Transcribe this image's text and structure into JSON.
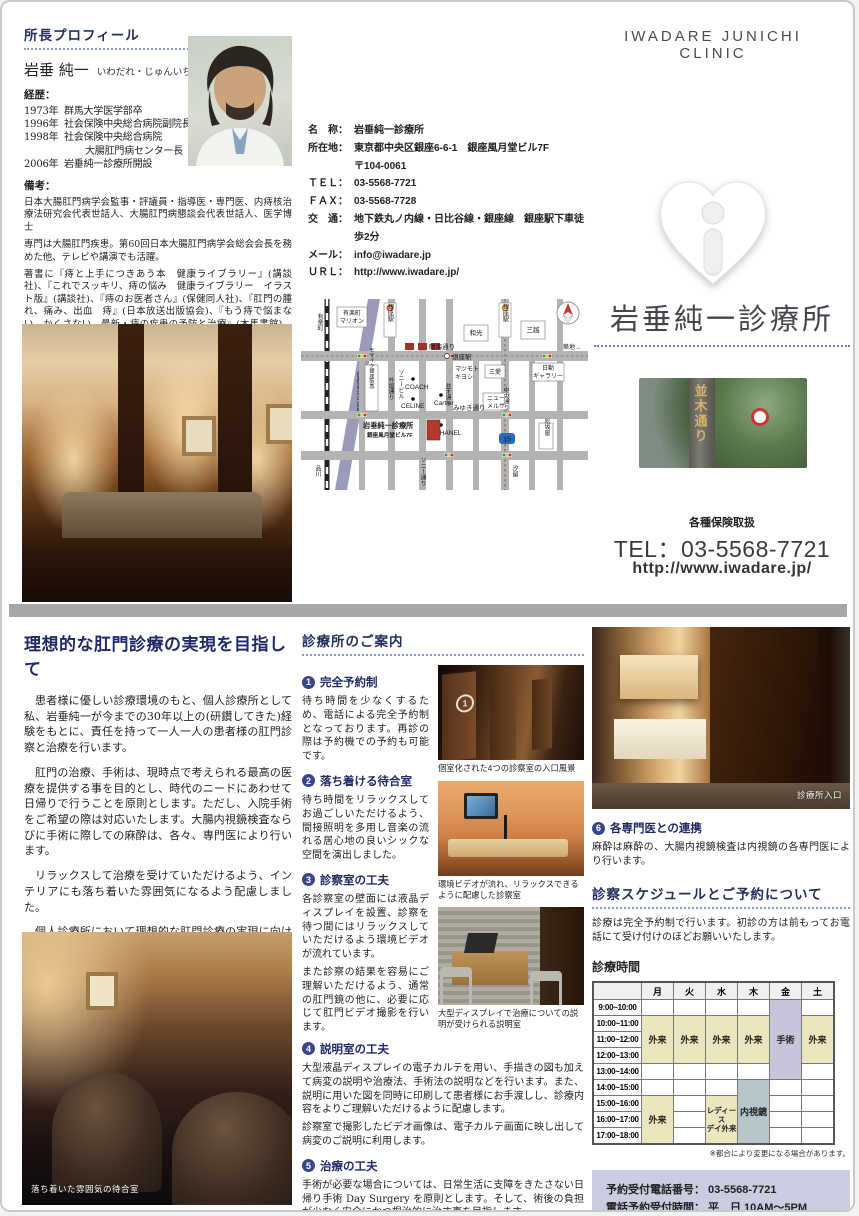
{
  "brand": {
    "header": "IWADARE JUNICHI CLINIC",
    "name": "岩垂純一診療所",
    "insurance_note": "各種保険取扱",
    "tel": "TEL：03-5568-7721",
    "url": "http://www.iwadare.jp/",
    "sign_text": "並木通り"
  },
  "profile": {
    "heading": "所長プロフィール",
    "name": "岩垂 純一",
    "kana": "いわだれ・じゅんいち",
    "career_label": "経歴：",
    "career": [
      [
        "1973年",
        "群馬大学医学部卒"
      ],
      [
        "1996年",
        "社会保険中央総合病院副院長"
      ],
      [
        "1998年",
        "社会保険中央総合病院"
      ],
      [
        "",
        "大腸肛門病センター長"
      ],
      [
        "2006年",
        "岩垂純一診療所開設"
      ]
    ],
    "notes_label": "備考：",
    "notes": [
      "日本大腸肛門病学会監事・評議員・指導医・専門医、内痔核治療法研究会代表世話人、大腸肛門病懇談会代表世話人、医学博士",
      "専門は大腸肛門疾患。第60回日本大腸肛門病学会総会会長を務めた他、テレビや講演でも活躍。",
      "著書に『痔と上手につきあう本　健康ライブラリー』(講談社)、『これでスッキリ、痔の悩み　健康ライブラリー　イラスト版』(講談社)、『痔のお医者さん』(保健同人社)、『肛門の腫れ、痛み、出血　痔』(日本放送出版協会)、『もう痔で悩まない、かくさない　最新・痔の疾患の予防と治療』(木馬書館)、『実地医家のための肛門疾患診療プラクティス』(永井書店)、『肛門疾患Day　Surgeryの実際―私はこのように行っている』(真興交易(株)医書出版部)など。"
    ]
  },
  "contact": {
    "rows": [
      [
        "名　称：",
        "岩垂純一診療所"
      ],
      [
        "所在地：",
        "東京都中央区銀座6-6-1　銀座風月堂ビル7F"
      ],
      [
        "",
        "〒104-0061"
      ],
      [
        "ＴＥＬ：",
        "03-5568-7721"
      ],
      [
        "ＦＡＸ：",
        "03-5568-7728"
      ],
      [
        "交　通：",
        "地下鉄丸ノ内線・日比谷線・銀座線　銀座駅下車徒歩2分"
      ],
      [
        "メール：",
        "info@iwadare.jp"
      ],
      [
        "ＵＲＬ：",
        "http://www.iwadare.jp/"
      ]
    ]
  },
  "map": {
    "labels": {
      "yurakucho": "有楽町",
      "marion1": "有楽町",
      "marion2": "マリオン",
      "ginza_sta": "銀座駅",
      "harumi": "晴海通り",
      "tsukiji": "築地→",
      "wako": "和光",
      "mitsukoshi": "三越",
      "nichido1": "日動",
      "nichido2": "ギャラリー",
      "mosaic": "モザイク銀座阪急",
      "sotobori": "外堀通り",
      "sony_bldg": "ソニービル",
      "coach": "COACH",
      "matsukiyo1": "マツモト",
      "matsukiyo2": "キヨシ",
      "namiki": "並木通り",
      "celine": "CELINE",
      "cartier": "Cartier",
      "sanai": "三愛",
      "melsa1": "ニュー",
      "melsa2": "メルサ",
      "chuo": "中央通り",
      "miyuki": "みゆき通り",
      "chanel": "CHANEL",
      "route15": "15",
      "matsuzakaya": "松坂屋",
      "sony_st": "ソニー通り",
      "expressway": "首都高速の連絡線",
      "shinagawa": "品川",
      "shiodome": "汐留"
    },
    "clinic": {
      "line1": "岩垂純一診療所",
      "line2": "銀座風月堂ビル7F"
    }
  },
  "article": {
    "title": "理想的な肛門診療の実現を目指して",
    "paragraphs": [
      "患者様に優しい診療環境のもと、個人診療所として私、岩垂純一が今までの30年以上の(研鑽してきた)経験をもとに、責任を持って一人一人の患者様の肛門診察と治療を行います。",
      "肛門の治療、手術は、現時点で考えられる最高の医療を提供する事を目的とし、時代のニードにあわせて日帰りで行うことを原則とします。ただし、入院手術をご希望の際は対応いたします。大腸内視鏡検査ならびに手術に際しての麻酔は、各々、専門医により行います。",
      "リラックスして治療を受けていただけるよう、インテリアにも落ち着いた雰囲気になるよう配慮しました。",
      "個人診療所において理想的な肛門診療の実現に向けて日々、努力してまいりたいと思いますので、よろしくお願い申し上げます。"
    ],
    "signature_role": "所長",
    "signature_name": "岩垂 純一"
  },
  "guide": {
    "heading": "診療所のご案内",
    "sections": [
      {
        "num": "1",
        "title": "完全予約制",
        "body": "待ち時間を少なくするため、電話による完全予約制となっております。再診の際は予約機での予約も可能です。"
      },
      {
        "num": "2",
        "title": "落ち着ける待合室",
        "body": "待ち時間をリラックスしてお過ごしいただけるよう、間接照明を多用し音楽の流れる居心地の良いシックな空間を演出しました。"
      },
      {
        "num": "3",
        "title": "診察室の工夫",
        "body": "各診察室の壁面には液晶ディスプレイを設置、診察を待つ間にはリラックスしていただけるよう環境ビデオが流れています。",
        "body2": "また診察の結果を容易にご理解いただけるよう、通常の肛門鏡の他に、必要に応じて肛門ビデオ撮影を行います。"
      },
      {
        "num": "4",
        "title": "説明室の工夫",
        "body": "大型液晶ディスプレイの電子カルテを用い、手描きの図も加えて病変の説明や治療法、手術法の説明などを行います。また、説明に用いた図を同時に印刷して患者様にお手渡しし、診療内容をよりご理解いただけるように配慮します。",
        "body2": "診察室で撮影したビデオ画像は、電子カルテ画面に映し出して病変のご説明に利用します。"
      },
      {
        "num": "5",
        "title": "治療の工夫",
        "body": "手術が必要な場合については、日常生活に支障をきたさない日帰り手術 Day Surgery を原則とします。そして、術後の負担が少なく安全にかつ根治的に治す事を目指します。"
      },
      {
        "num": "6",
        "title": "各専門医との連携",
        "body": "麻酔は麻酔の、大腸内視鏡検査は内視鏡の各専門医により行います。"
      }
    ]
  },
  "photo_captions": {
    "rooms": "個室化された4つの診察室の入口風景",
    "exam": "環境ビデオが流れ、リラックスできるように配慮した診察室",
    "explain": "大型ディスプレイで治療についての説明が受けられる説明室",
    "entrance": "診療所入口",
    "waiting": "落ち着いた雰囲気の待合室",
    "door_number": "1"
  },
  "schedule": {
    "heading": "診察スケジュールとご予約について",
    "intro": "診療は完全予約制で行います。初診の方は前もってお電話にて受け付けのほどお願いいたします。",
    "table_title": "診療時間",
    "days": [
      "月",
      "火",
      "水",
      "木",
      "金",
      "土"
    ],
    "times": [
      "9:00~10:00",
      "10:00~11:00",
      "11:00~12:00",
      "12:00~13:00",
      "13:00~14:00",
      "14:00~15:00",
      "15:00~16:00",
      "16:00~17:00",
      "17:00~18:00"
    ],
    "cells": {
      "outpatient": "外来",
      "ladies1": "レディース",
      "ladies2": "デイ外来",
      "endoscopy": "内視鏡",
      "surgery": "手術"
    },
    "note": "※都合により変更になる場合があります。",
    "reservation": {
      "tel_label": "予約受付電話番号：",
      "tel": "03-5568-7721",
      "hours_label": "電話予約受付時間：",
      "hours1": "平　日 10AM～5PM",
      "hours2": "土曜日 10AM～1PM"
    }
  },
  "colors": {
    "accent_navy": "#23305e",
    "outpatient_yellow": "#ece6bf",
    "surgery_purple": "#c6c5da",
    "endoscopy_bluegray": "#b7c6ca",
    "reservation_lavender": "#cbcce0",
    "clinic_marker_red": "#b03a2e"
  }
}
